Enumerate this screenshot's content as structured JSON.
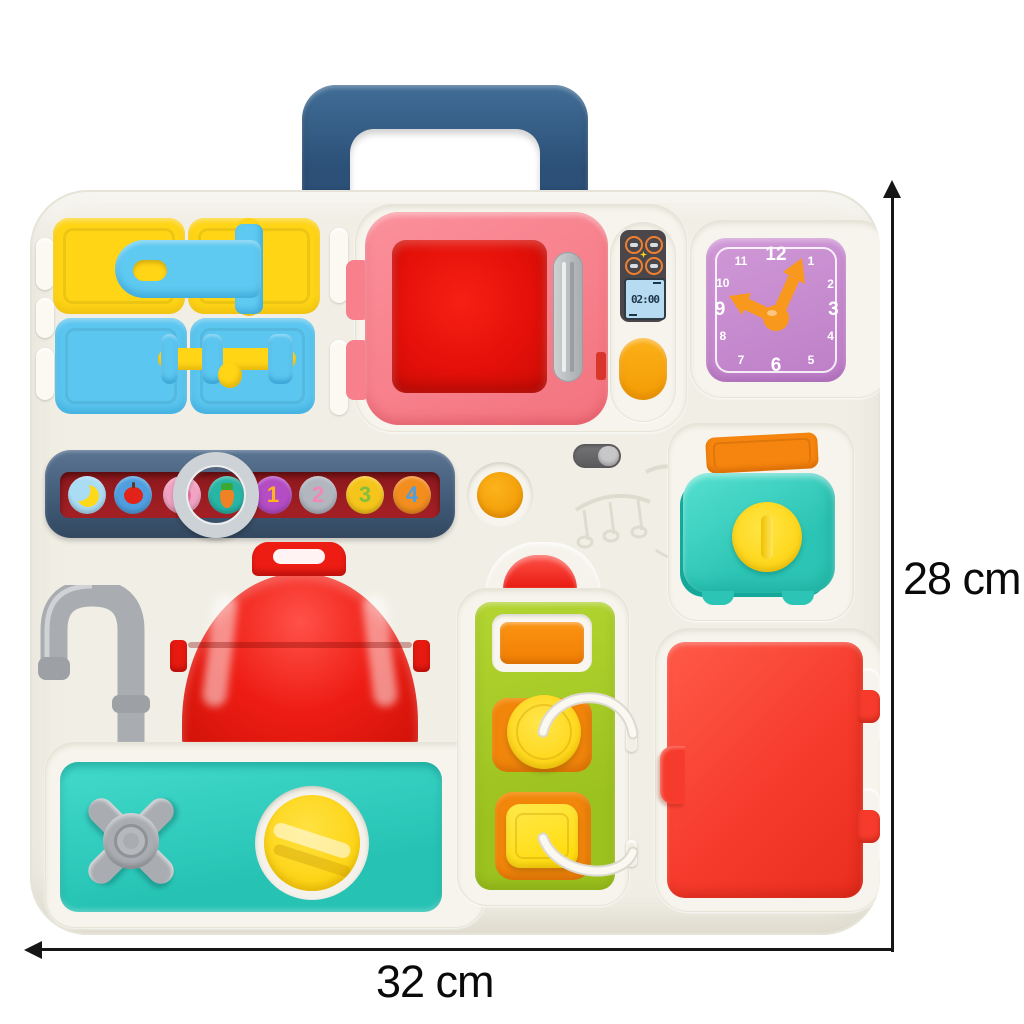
{
  "annotations": {
    "height_label": "28 cm",
    "width_label": "32 cm"
  },
  "microwave": {
    "display_time": "02:00",
    "food_icons": [
      "drumstick",
      "broccoli",
      "noodles",
      "fish"
    ]
  },
  "clock": {
    "numbers": [
      "12",
      "1",
      "2",
      "3",
      "4",
      "5",
      "6",
      "7",
      "8",
      "9",
      "10",
      "11"
    ]
  },
  "slider": {
    "tiles": [
      {
        "name": "banana"
      },
      {
        "name": "apple"
      },
      {
        "name": "strawberry"
      },
      {
        "name": "carrot"
      },
      {
        "name": "number-1",
        "label": "1"
      },
      {
        "name": "number-2",
        "label": "2"
      },
      {
        "name": "number-3",
        "label": "3"
      },
      {
        "name": "number-4",
        "label": "4"
      }
    ]
  },
  "colors": {
    "board": "#f1efe5",
    "handle_navy": "#31567d",
    "door_yellow": "#ffd516",
    "door_blue": "#5bc6f0",
    "microwave_pink": "#f8808d",
    "red": "#ee1d14",
    "orange": "#f59c05",
    "clock_face": "#c588ce",
    "clock_hands": "#f8981d",
    "slider_bar": "#44607f",
    "slider_track": "#a42025",
    "teal": "#2cc4b4",
    "lime_green": "#a6cb2a",
    "fridge_red": "#f63b2c",
    "gray": "#a9adb2",
    "knob_yellow": "#ffd400"
  }
}
